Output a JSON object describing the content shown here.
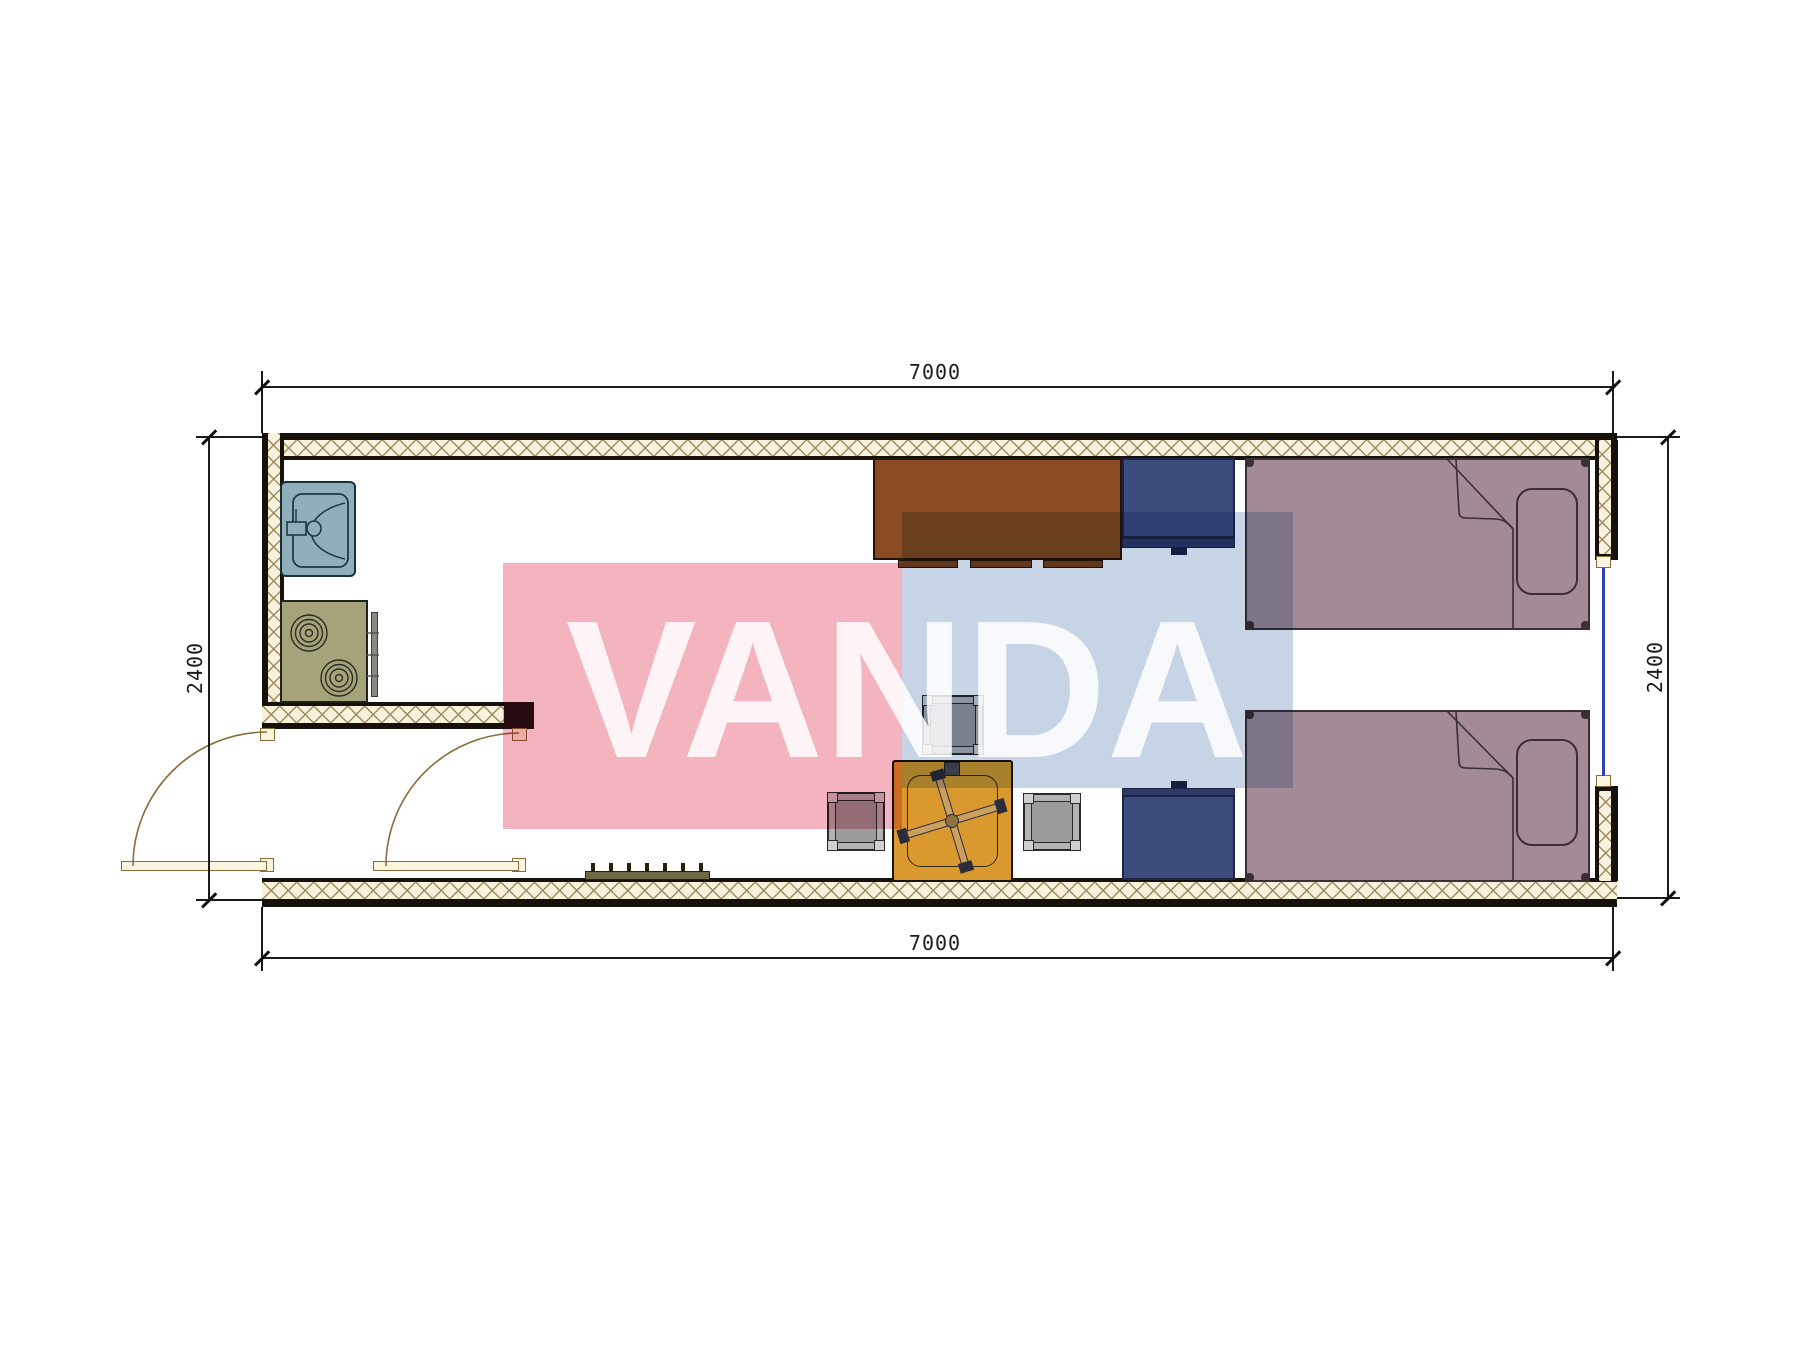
{
  "plan": {
    "type": "floor-plan",
    "dimensions": {
      "top": "7000",
      "bottom": "7000",
      "left": "2400",
      "right": "2400"
    },
    "furniture": [
      {
        "name": "sink"
      },
      {
        "name": "stove"
      },
      {
        "name": "entry-door-left"
      },
      {
        "name": "entry-door-right"
      },
      {
        "name": "desk"
      },
      {
        "name": "cabinet-top"
      },
      {
        "name": "cabinet-bottom"
      },
      {
        "name": "bed-top"
      },
      {
        "name": "bed-bottom"
      },
      {
        "name": "table"
      },
      {
        "name": "office-chair-base"
      },
      {
        "name": "stool-top"
      },
      {
        "name": "stool-left"
      },
      {
        "name": "stool-right"
      },
      {
        "name": "radiator"
      },
      {
        "name": "window"
      }
    ]
  },
  "watermark": {
    "text": "VANDA"
  },
  "colors": {
    "wall_bg": "#f7f1de",
    "wall_hatch": "#9f8b5e",
    "wall_line": "#17110b",
    "desk": "#8a4a23",
    "navy": "#3d4b7d",
    "navy_dark": "#2e3a66",
    "bed": "#a28b96",
    "bed_line": "#3b2e35",
    "table": "#d9992e",
    "stool": "#b3b3b3",
    "sink": "#8fb0ba",
    "stove": "#a6a37b",
    "door": "#8a6b3a",
    "door_leaf": "#fbf4de",
    "dim": "#1b1b1b",
    "window": "#3240b5",
    "partition_cap": "#2b1014",
    "radiator": "#6f6847",
    "wm_pink": "#f3b3bf",
    "wm_blue": "#c6d4e6",
    "wm_text": "rgba(255,255,255,0.85)",
    "page": "#ffffff"
  }
}
